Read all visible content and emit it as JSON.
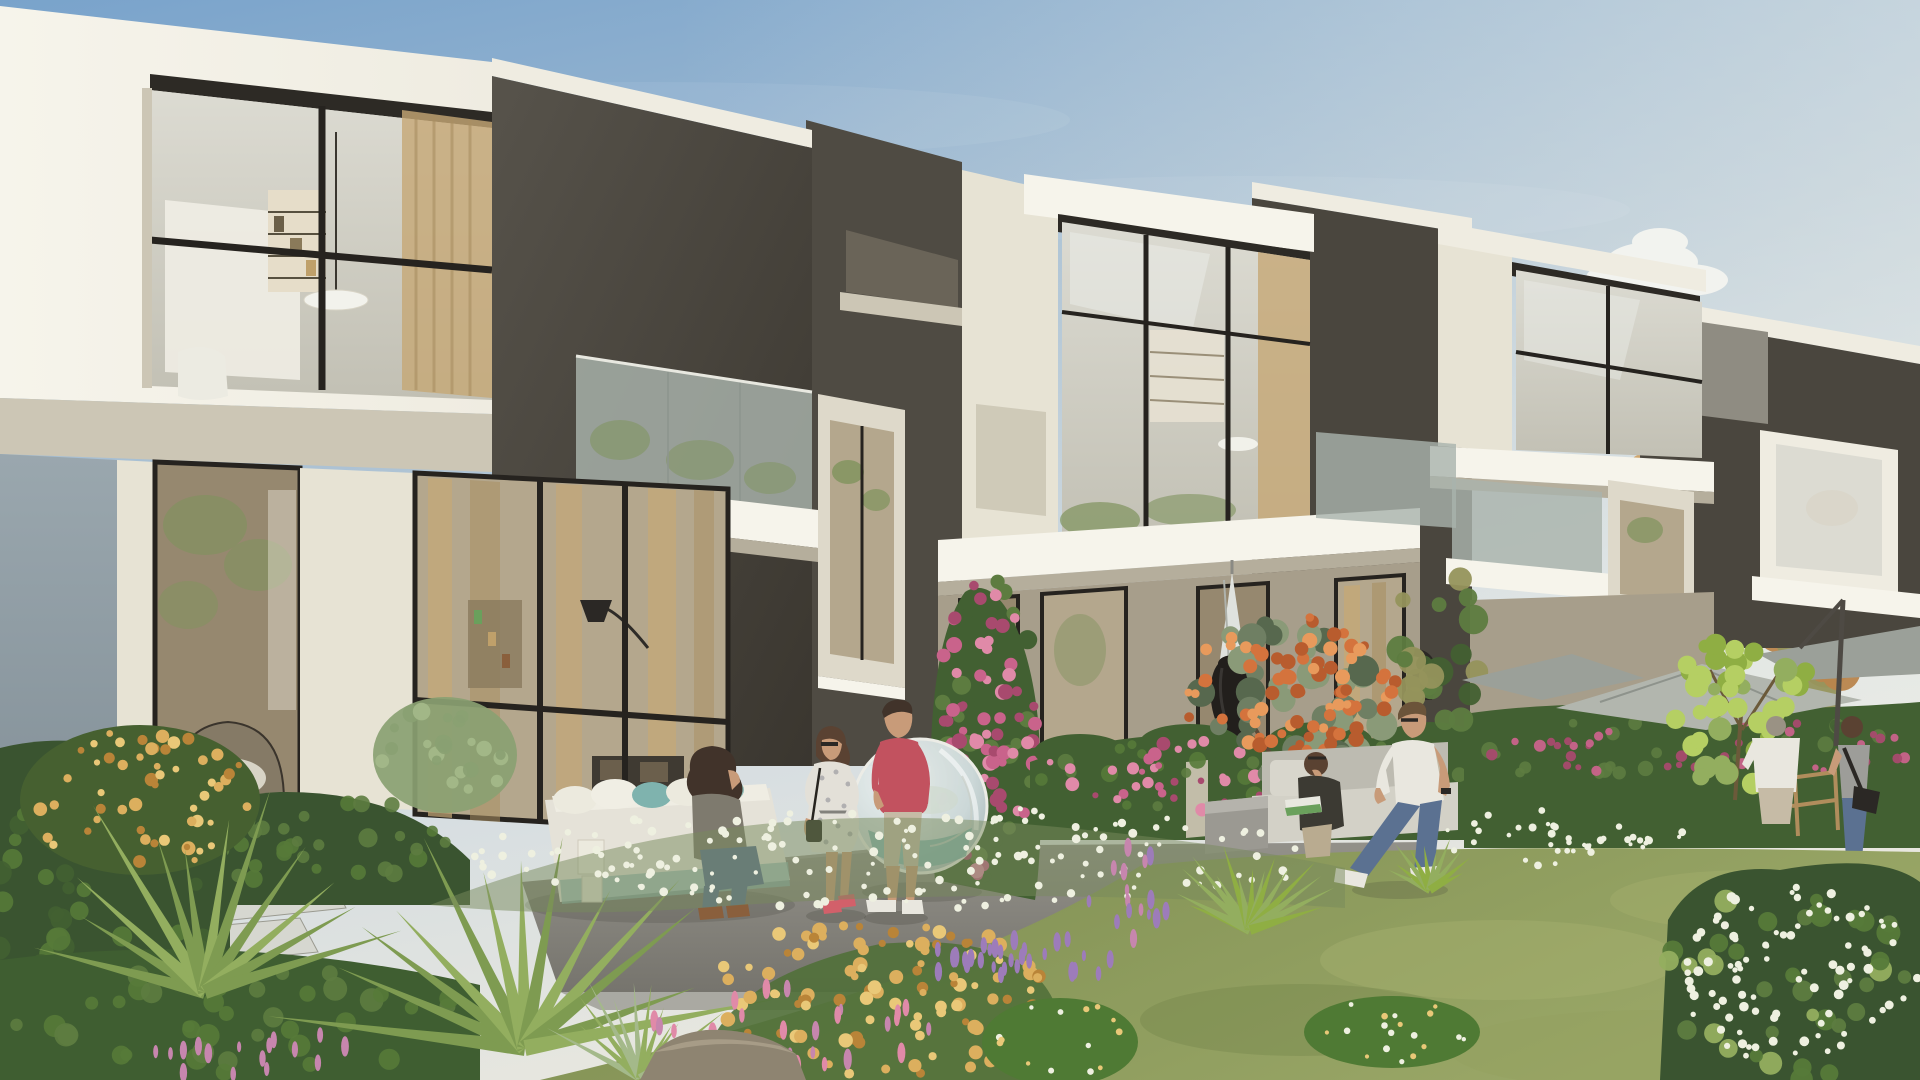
{
  "meta": {
    "title": "Modern townhouse community — exterior garden rendering"
  },
  "scene": {
    "type": "architectural-render",
    "description": "Row of modern two-storey townhouses with charcoal and cream cubic facades, large black-framed glazing, glass balconies; lush landscaped garden in front with lawn, flower beds, fan palms, pink bougainvillea hedges, an orange flowering tree; residents relaxing on terraces.",
    "buildings": [
      {
        "name": "townhouse-left",
        "features": "white framed double-height glazed box, charcoal facade, glass balcony, tall ground-floor windows with tan curtains, hanging dome chair inside"
      },
      {
        "name": "townhouse-middle",
        "features": "cream upper box with reflective glazing, dark portal frame, beige ground floor with black framed doors, closed white parasol"
      },
      {
        "name": "townhouse-right",
        "features": "charcoal block with cream glazed box, glass balcony, arched portal opening"
      },
      {
        "name": "townhouse-far-right",
        "features": "partially visible behind autumn trees, cream fascia and window box"
      }
    ],
    "people": [
      {
        "name": "seated-woman",
        "detail": "dark curly hair, olive-grey top, blue jeans, tan boots, seated on white daybed"
      },
      {
        "name": "standing-woman",
        "detail": "floral white dress, sunglasses, ponytail, black handbag, coral sandals, laughing"
      },
      {
        "name": "standing-man",
        "detail": "coral-red t-shirt, grey-beige cargo shorts, white sneakers"
      },
      {
        "name": "reading-woman",
        "detail": "dark jacket, sunglasses on head, green magazine, seated on grey outdoor sofa"
      },
      {
        "name": "walking-man",
        "detail": "white t-shirt, blue jeans, sunglasses, walking across the garden path"
      },
      {
        "name": "man-white-shirt-right",
        "detail": "white shirt and beige shorts, standing by the hedge"
      },
      {
        "name": "woman-with-camera",
        "detail": "grey tank top, jeans, black camera bag"
      }
    ],
    "objects": [
      "transparent sphere hanging chair",
      "white outdoor daybed with teal cushions",
      "white lantern boxes",
      "grey outdoor sofa with coffee table",
      "black urn planter",
      "closed white parasol",
      "grey cantilever parasols",
      "wooden bistro chair",
      "stone steps",
      "garden boulder"
    ],
    "vegetation": [
      "olive green lawn",
      "fan palms",
      "white flower drift",
      "apricot flower bush",
      "purple salvia spikes",
      "pink spike flowers",
      "bougainvillea hedges",
      "orange flowering tree",
      "lime ficus",
      "autumn trees",
      "golden flower shrub"
    ]
  },
  "colors": {
    "sky_top": "#79a3cb",
    "sky_mid": "#aec3d4",
    "sky_low": "#d7dee1",
    "sky_horizon": "#e8e7df",
    "cloud": "#f6f6f1",
    "charcoal": "#4a463e",
    "charcoal_mid": "#4f4b43",
    "charcoal_light": "#57534b",
    "charcoal_dark": "#3a362f",
    "cream": "#efece1",
    "cream2": "#e7e3d4",
    "cream_bright": "#f6f4eb",
    "cream_shadow": "#ccc6b5",
    "cream_warm": "#b5ae9c",
    "grey_face": "#8f8c82",
    "arch_inner": "#ded9ca",
    "dark_glass": "#6a6458",
    "side_wall": "#9aa7ae",
    "side_wall_dark": "#7e8b93",
    "beige_wall": "#a79e8b",
    "beige_pier": "#c9c2b0",
    "frame_black": "#26231f",
    "soffit": "#2d2a25",
    "glass_cool": "#dcdbd2",
    "glass_cool_dark": "#c2c0b4",
    "glass_warm": "#b4a78d",
    "glass_warm_dark": "#96886f",
    "curtain": "#c5a876",
    "curtain_dark": "#a98f62",
    "balcony_glass": "#a9b3ac",
    "reflection_green": "#7f935d",
    "terrace": "#93918a",
    "terrace_dark": "#76746d",
    "step_stone": "#d6d7d0",
    "lawn_light": "#9aa767",
    "lawn_dark": "#7c8c50",
    "patch_green": "#4f7a34",
    "hedge": "#426032",
    "hedge_light": "#5d7c40",
    "shrub_dark": "#3a5430",
    "shrub_light": "#567a39",
    "sage": "#8aa172",
    "sage_light": "#a4b98a",
    "palm": "#7e9b51",
    "palm_light": "#93ae5f",
    "ficus": "#8fae43",
    "ficus_light": "#b5cf63",
    "tree_leaf": "#6f7f63",
    "tree_leaf_dark": "#57684e",
    "tree_leaf_light": "#8a9a78",
    "flower_orange": "#d4733d",
    "flower_orange_light": "#e89a5c",
    "flower_orange_dark": "#b85c2e",
    "flower_pink": "#c9638b",
    "flower_pink_light": "#e08aa8",
    "flower_pink_dark": "#a84a6e",
    "flower_pink_spike": "#c786ae",
    "flower_purple": "#9d7cba",
    "flower_white": "#eef0e0",
    "flower_yellow": "#dcaf5e",
    "flower_yellow_light": "#e9c878",
    "gold_dark": "#b98438",
    "autumn": "#b9854c",
    "autumn_light": "#cfa061",
    "autumn_olive": "#95945c",
    "sofa_white": "#e5e2d8",
    "cushion_teal": "#7fb3ae",
    "sofa_grey": "#d3d1c7",
    "sofa_grey_dark": "#bdbbb1",
    "sphere_rim": "#ecece6",
    "sphere_glass": "#ccd8d8",
    "umbrella_grey": "#b2b6ae",
    "umbrella_grey_dark": "#9ba099",
    "umbrella_white": "#dfe2de",
    "urn_black": "#221f1c",
    "wood": "#b08d5c",
    "rock": "#8e8471",
    "rock_light": "#a79c87",
    "skin": "#c89b79",
    "hair_dark": "#41332a",
    "hair_brown": "#5a4232",
    "hair_blond": "#6b543a",
    "hair_grey": "#9a9284",
    "shirt_red": "#c2525f",
    "shirt_white": "#e9e7df",
    "dress_white": "#e3e0d8",
    "jeans": "#5b7191",
    "shorts_beige": "#c6bba6",
    "boots_brown": "#8a5f3c",
    "sandal_coral": "#d2606a",
    "tank_grey": "#9d9d99",
    "jacket_dark": "#3c3a33",
    "cardigan": "#7e7a6e",
    "book_green": "#6aa05c"
  },
  "clusters": [
    {
      "name": "bg-autumn-right",
      "cx": 1838,
      "cy": 540,
      "rx": 85,
      "ry": 160,
      "n": 45,
      "rmin": 10,
      "rmax": 26,
      "colors": [
        "autumn",
        "autumn_light",
        "autumn_olive"
      ],
      "seed": 101,
      "op": 0.95
    },
    {
      "name": "bg-autumn-mid",
      "cx": 1665,
      "cy": 470,
      "rx": 55,
      "ry": 55,
      "n": 16,
      "rmin": 8,
      "rmax": 18,
      "colors": [
        "autumn_light",
        "autumn_olive"
      ],
      "seed": 102,
      "op": 0.9
    },
    {
      "name": "bg-green-gap",
      "cx": 1440,
      "cy": 645,
      "rx": 42,
      "ry": 105,
      "n": 22,
      "rmin": 7,
      "rmax": 16,
      "colors": [
        "hedge_light",
        "autumn_olive",
        "hedge"
      ],
      "seed": 103,
      "op": 0.95
    },
    {
      "name": "vine-pink",
      "cx": 986,
      "cy": 730,
      "rx": 50,
      "ry": 150,
      "n": 70,
      "rmin": 4,
      "rmax": 8,
      "colors": [
        "flower_pink",
        "flower_pink_light",
        "flower_pink_dark"
      ],
      "seed": 104,
      "op": 1
    },
    {
      "name": "vine-leaf",
      "cx": 985,
      "cy": 725,
      "rx": 52,
      "ry": 152,
      "n": 34,
      "rmin": 5,
      "rmax": 10,
      "colors": [
        "hedge_light",
        "hedge"
      ],
      "seed": 105,
      "op": 1
    },
    {
      "name": "hedge-mid-pink",
      "cx": 1246,
      "cy": 776,
      "rx": 215,
      "ry": 36,
      "n": 55,
      "rmin": 3,
      "rmax": 7,
      "colors": [
        "flower_pink",
        "flower_pink_light",
        "flower_pink_dark"
      ],
      "seed": 106,
      "op": 1
    },
    {
      "name": "hedge-mid-leaf",
      "cx": 1246,
      "cy": 776,
      "rx": 218,
      "ry": 40,
      "n": 45,
      "rmin": 4,
      "rmax": 9,
      "colors": [
        "hedge_light",
        "shrub_light"
      ],
      "seed": 107,
      "op": 0.9
    },
    {
      "name": "hedge-right-pink",
      "cx": 1692,
      "cy": 748,
      "rx": 225,
      "ry": 30,
      "n": 40,
      "rmin": 3,
      "rmax": 6,
      "colors": [
        "flower_pink",
        "flower_pink_dark"
      ],
      "seed": 108,
      "op": 0.95
    },
    {
      "name": "hedge-right-leaf",
      "cx": 1692,
      "cy": 750,
      "rx": 228,
      "ry": 36,
      "n": 36,
      "rmin": 4,
      "rmax": 9,
      "colors": [
        "hedge_light",
        "hedge"
      ],
      "seed": 109,
      "op": 0.9
    },
    {
      "name": "tree-leaf",
      "cx": 1292,
      "cy": 700,
      "rx": 105,
      "ry": 80,
      "n": 40,
      "rmin": 8,
      "rmax": 16,
      "colors": [
        "tree_leaf",
        "tree_leaf_dark",
        "tree_leaf_light"
      ],
      "seed": 110,
      "op": 1
    },
    {
      "name": "tree-orange",
      "cx": 1292,
      "cy": 698,
      "rx": 108,
      "ry": 82,
      "n": 85,
      "rmin": 4,
      "rmax": 8,
      "colors": [
        "flower_orange",
        "flower_orange_light",
        "flower_orange_dark"
      ],
      "seed": 111,
      "op": 1
    },
    {
      "name": "ficus-leaves",
      "cx": 1742,
      "cy": 712,
      "rx": 85,
      "ry": 75,
      "n": 48,
      "rmin": 6,
      "rmax": 12,
      "colors": [
        "ficus",
        "ficus_light",
        "palm_light"
      ],
      "seed": 112,
      "op": 1
    },
    {
      "name": "golden-bush",
      "cx": 140,
      "cy": 800,
      "rx": 115,
      "ry": 70,
      "n": 55,
      "rmin": 3,
      "rmax": 7,
      "colors": [
        "flower_yellow",
        "flower_yellow_light",
        "gold_dark"
      ],
      "seed": 113,
      "op": 1
    },
    {
      "name": "shrub-band-tex",
      "cx": 300,
      "cy": 840,
      "rx": 150,
      "ry": 45,
      "n": 40,
      "rmin": 5,
      "rmax": 10,
      "colors": [
        "shrub_light",
        "hedge_light"
      ],
      "seed": 114,
      "op": 0.9
    },
    {
      "name": "left-mound-tex",
      "cx": 100,
      "cy": 900,
      "rx": 120,
      "ry": 140,
      "n": 50,
      "rmin": 6,
      "rmax": 12,
      "colors": [
        "shrub_light",
        "hedge"
      ],
      "seed": 115,
      "op": 0.9
    },
    {
      "name": "lower-band-tex",
      "cx": 240,
      "cy": 1020,
      "rx": 230,
      "ry": 55,
      "n": 40,
      "rmin": 6,
      "rmax": 12,
      "colors": [
        "shrub_light",
        "hedge_light"
      ],
      "seed": 116,
      "op": 0.9
    },
    {
      "name": "white-drift-main",
      "cx": 890,
      "cy": 858,
      "rx": 430,
      "ry": 52,
      "n": 160,
      "rmin": 2,
      "rmax": 4.5,
      "colors": [
        "flower_white"
      ],
      "seed": 117,
      "op": 1
    },
    {
      "name": "white-drift-right",
      "cx": 1560,
      "cy": 838,
      "rx": 130,
      "ry": 28,
      "n": 40,
      "rmin": 2,
      "rmax": 4,
      "colors": [
        "flower_white"
      ],
      "seed": 118,
      "op": 1
    },
    {
      "name": "apricot-bed",
      "cx": 880,
      "cy": 1000,
      "rx": 180,
      "ry": 80,
      "n": 110,
      "rmin": 3.5,
      "rmax": 7.5,
      "colors": [
        "flower_yellow",
        "flower_yellow_light",
        "gold_dark"
      ],
      "seed": 119,
      "op": 1
    },
    {
      "name": "purple-spikes-1",
      "cx": 1020,
      "cy": 962,
      "rx": 95,
      "ry": 28,
      "n": 30,
      "rmin": 2,
      "rmax": 4,
      "colors": [
        "flower_purple"
      ],
      "seed": 120,
      "op": 1,
      "elong": true
    },
    {
      "name": "purple-spikes-2",
      "cx": 1128,
      "cy": 898,
      "rx": 40,
      "ry": 55,
      "n": 16,
      "rmin": 2,
      "rmax": 4,
      "colors": [
        "flower_purple",
        "flower_pink_spike"
      ],
      "seed": 121,
      "op": 1,
      "elong": true
    },
    {
      "name": "pink-spikes-1",
      "cx": 790,
      "cy": 1020,
      "rx": 150,
      "ry": 50,
      "n": 24,
      "rmin": 2,
      "rmax": 4.5,
      "colors": [
        "flower_pink_spike",
        "flower_pink_light"
      ],
      "seed": 122,
      "op": 1,
      "elong": true
    },
    {
      "name": "pink-spikes-2",
      "cx": 258,
      "cy": 1056,
      "rx": 115,
      "ry": 26,
      "n": 16,
      "rmin": 2,
      "rmax": 4,
      "colors": [
        "flower_pink_spike"
      ],
      "seed": 123,
      "op": 1,
      "elong": true
    },
    {
      "name": "patch1-dots",
      "cx": 1392,
      "cy": 1032,
      "rx": 82,
      "ry": 32,
      "n": 18,
      "rmin": 2,
      "rmax": 3.5,
      "colors": [
        "flower_yellow_light",
        "flower_white"
      ],
      "seed": 124,
      "op": 1
    },
    {
      "name": "patch2-dots",
      "cx": 1060,
      "cy": 1038,
      "rx": 72,
      "ry": 40,
      "n": 14,
      "rmin": 2,
      "rmax": 3.5,
      "colors": [
        "flower_yellow_light",
        "flower_white"
      ],
      "seed": 125,
      "op": 1
    },
    {
      "name": "corner-white",
      "cx": 1800,
      "cy": 975,
      "rx": 125,
      "ry": 95,
      "n": 90,
      "rmin": 2.5,
      "rmax": 5,
      "colors": [
        "flower_white"
      ],
      "seed": 126,
      "op": 1
    },
    {
      "name": "corner-leaf",
      "cx": 1795,
      "cy": 980,
      "rx": 130,
      "ry": 100,
      "n": 40,
      "rmin": 6,
      "rmax": 12,
      "colors": [
        "hedge_light",
        "shrub_light",
        "palm_light"
      ],
      "seed": 127,
      "op": 0.95
    },
    {
      "name": "sage-tex",
      "cx": 445,
      "cy": 752,
      "rx": 64,
      "ry": 50,
      "n": 22,
      "rmin": 4,
      "rmax": 9,
      "colors": [
        "sage_light",
        "sage"
      ],
      "seed": 128,
      "op": 0.9
    },
    {
      "name": "stem-green",
      "cx": 930,
      "cy": 990,
      "rx": 240,
      "ry": 70,
      "n": 50,
      "rmin": 4,
      "rmax": 9,
      "colors": [
        "ficus_light",
        "palm_light",
        "hedge_light"
      ],
      "seed": 129,
      "op": 0.85
    }
  ],
  "fans": [
    {
      "name": "fan-palm-left",
      "cx": 205,
      "cy": 992,
      "n": 12,
      "a0": 195,
      "a1": 345,
      "lmin": 140,
      "lmax": 225,
      "w": 7,
      "colors": [
        "palm",
        "palm_light"
      ],
      "seed": 201
    },
    {
      "name": "fan-palm-center",
      "cx": 525,
      "cy": 1048,
      "n": 13,
      "a0": 190,
      "a1": 350,
      "lmin": 170,
      "lmax": 262,
      "w": 8,
      "colors": [
        "palm",
        "palm_light"
      ],
      "seed": 202
    },
    {
      "name": "yucca",
      "cx": 1250,
      "cy": 930,
      "n": 15,
      "a0": 200,
      "a1": 340,
      "lmin": 55,
      "lmax": 95,
      "w": 5,
      "colors": [
        "ficus",
        "palm_light"
      ],
      "seed": 203
    },
    {
      "name": "yucca-small",
      "cx": 1430,
      "cy": 890,
      "n": 10,
      "a0": 205,
      "a1": 335,
      "lmin": 35,
      "lmax": 60,
      "w": 4,
      "colors": [
        "palm_light",
        "ficus"
      ],
      "seed": 204
    },
    {
      "name": "grass-tuft",
      "cx": 640,
      "cy": 1078,
      "n": 12,
      "a0": 210,
      "a1": 330,
      "lmin": 60,
      "lmax": 110,
      "w": 4,
      "colors": [
        "palm_light",
        "sage_light"
      ],
      "seed": 205
    }
  ]
}
